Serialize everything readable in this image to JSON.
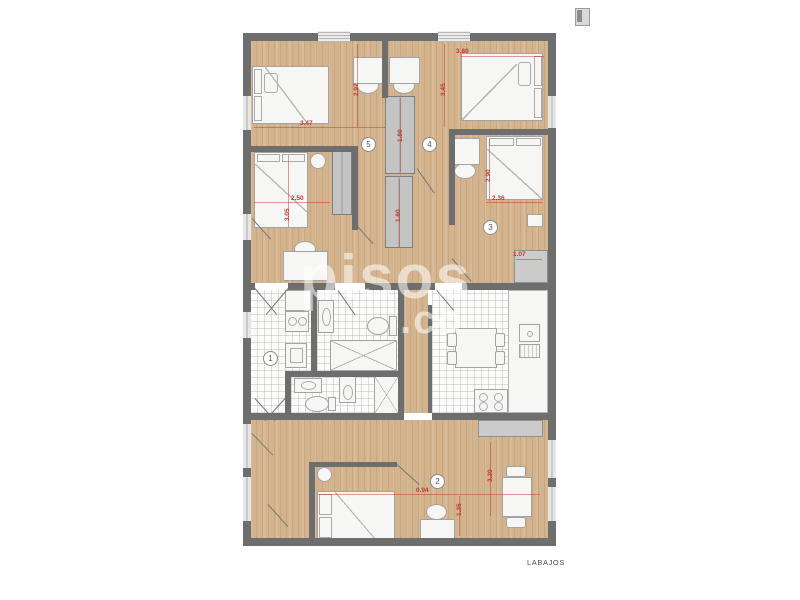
{
  "footer": {
    "label": "LABAJOS"
  },
  "watermark": {
    "primary": "pisos",
    "secondary": ".co"
  },
  "corner_icon": {
    "name": "thumbnail-icon"
  },
  "colors": {
    "wall": "#6e6e6e",
    "wood": "#d4b48e",
    "tile": "#fbfbfa",
    "closet": "#c4c4c4",
    "dimension_red": "#c0392b",
    "furniture": "#f6f6f4"
  },
  "rooms": [
    {
      "number": "1",
      "name": "hall-laundry"
    },
    {
      "number": "2",
      "name": "living-bedroom"
    },
    {
      "number": "3",
      "name": "bedroom-3"
    },
    {
      "number": "4",
      "name": "bedroom-4"
    },
    {
      "number": "5",
      "name": "bedroom-5"
    }
  ],
  "dimensions": [
    {
      "text": "3.47"
    },
    {
      "text": "2.97"
    },
    {
      "text": "3.80"
    },
    {
      "text": "3.45"
    },
    {
      "text": "2.50"
    },
    {
      "text": "3.05"
    },
    {
      "text": "2.36"
    },
    {
      "text": "2.90"
    },
    {
      "text": "1.80"
    },
    {
      "text": "1.60"
    },
    {
      "text": "1.07"
    },
    {
      "text": "0.94"
    },
    {
      "text": "3.20"
    },
    {
      "text": "1.35"
    }
  ]
}
